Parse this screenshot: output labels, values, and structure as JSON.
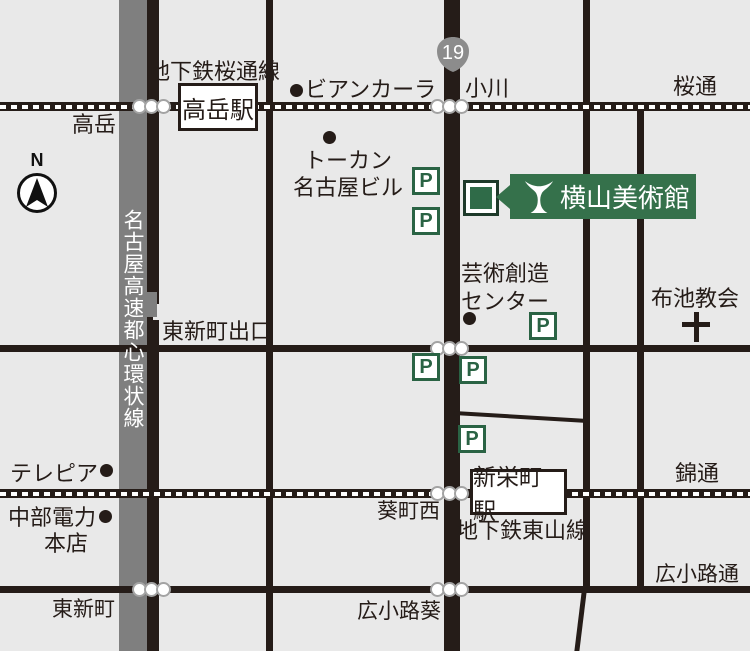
{
  "banner": {
    "title": "横山美術館"
  },
  "shield": {
    "route_number": "19"
  },
  "compass": {
    "north": "N"
  },
  "highway": {
    "name": "名古屋高速都心環状線"
  },
  "stations": {
    "takaoka": "高岳駅",
    "shinsakaemachi": "新栄町駅"
  },
  "lines": {
    "sakuradori_line": "地下鉄桜通線",
    "higashiyama_line": "地下鉄東山線"
  },
  "streets": {
    "sakuradori": "桜通",
    "nishikidori": "錦通",
    "hirokojidori": "広小路通"
  },
  "intersections": {
    "takaoka": "高岳",
    "ogawa": "小川",
    "higashishincho_exit": "東新町出口",
    "aoichonishi": "葵町西",
    "higashishincho": "東新町",
    "hirokojiaoi": "広小路葵"
  },
  "landmarks": {
    "biancara": "ビアンカーラ",
    "tokan_line1": "トーカン",
    "tokan_line2": "名古屋ビル",
    "geijutsu_line1": "芸術創造",
    "geijutsu_line2": "センター",
    "nunoike": "布池教会",
    "telepia": "テレピア",
    "chubu_line1": "中部電力",
    "chubu_line2": "本店"
  },
  "icons": {
    "parking": "P"
  },
  "colors": {
    "background": "#e9e9e9",
    "road": "#251c18",
    "highway_gray": "#7f7f7f",
    "banner_green": "#35714b",
    "parking_green": "#2a6344",
    "shield_gray": "#8c8c8c"
  }
}
